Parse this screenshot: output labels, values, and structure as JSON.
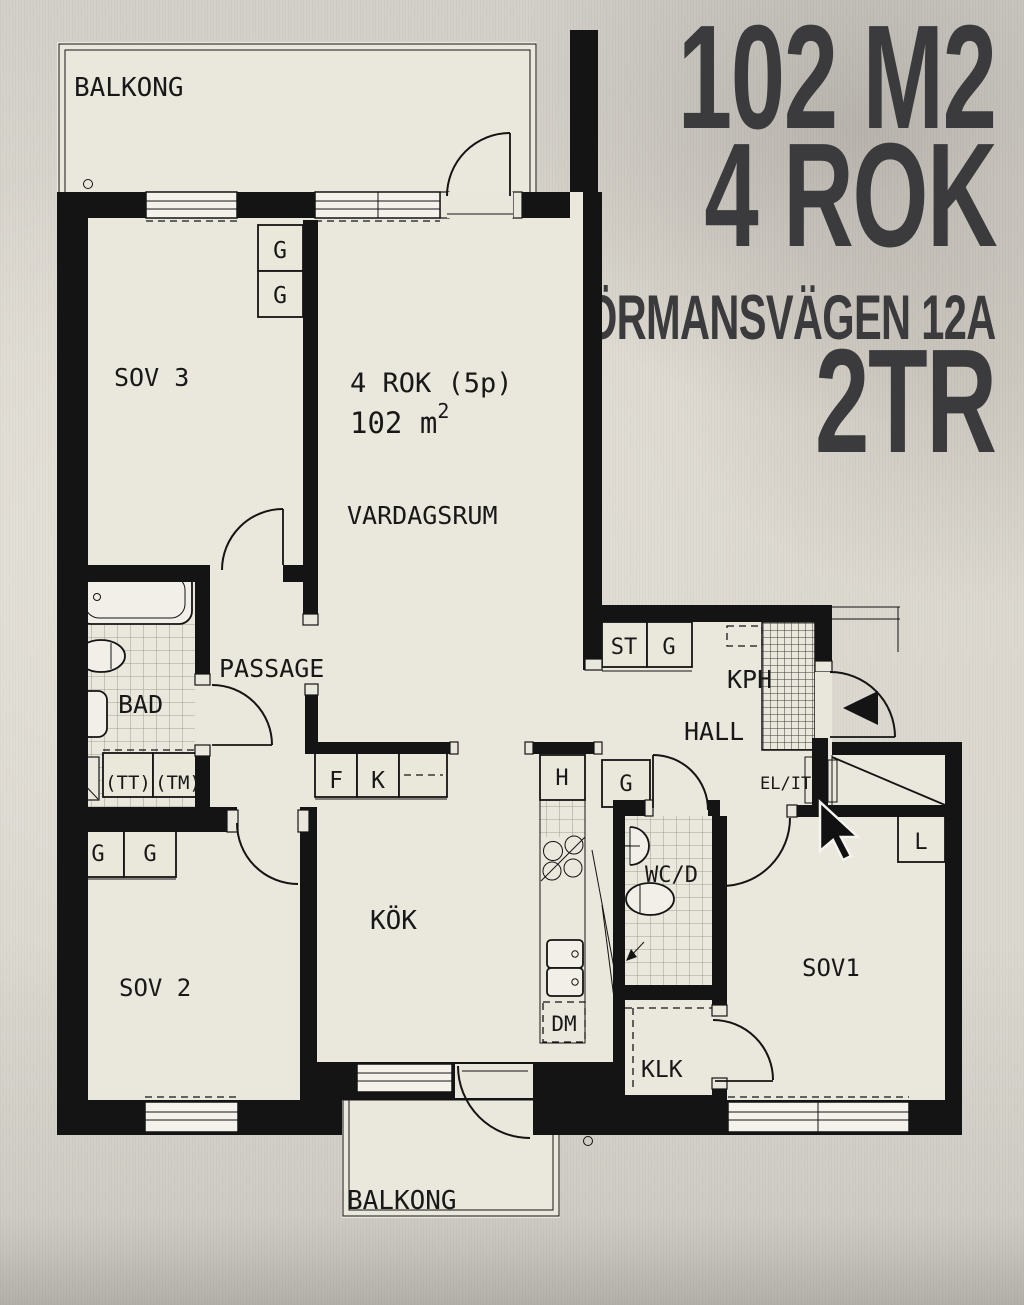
{
  "title": {
    "area": "102 M2",
    "rooms": "4 ROK",
    "address": "FÖRMANSVÄGEN 12A",
    "floor": "2TR"
  },
  "plan": {
    "balkong_top": "BALKONG",
    "balkong_bottom": "BALKONG",
    "sov3": "SOV 3",
    "sov2": "SOV 2",
    "sov1": "SOV1",
    "vardagsrum": "VARDAGSRUM",
    "kok": "KÖK",
    "bad": "BAD",
    "passage": "PASSAGE",
    "hall": "HALL",
    "kph": "KPH",
    "wcd": "WC/D",
    "klk": "KLK",
    "info_line1": "4 ROK (5p)",
    "info_line2": "102 m",
    "info_sup": "2",
    "closet_g": "G",
    "closet_st": "ST",
    "closet_f": "F",
    "closet_k": "K",
    "closet_h": "H",
    "closet_l": "L",
    "closet_dm": "DM",
    "el_it": "EL/IT",
    "tt": "(TT)",
    "tm": "(TM)"
  },
  "colors": {
    "paper": "#eae7dc",
    "background": "#d7d4cd",
    "ink": "#161616",
    "wall": "#141414",
    "title_ink": "#3b3a3c"
  }
}
